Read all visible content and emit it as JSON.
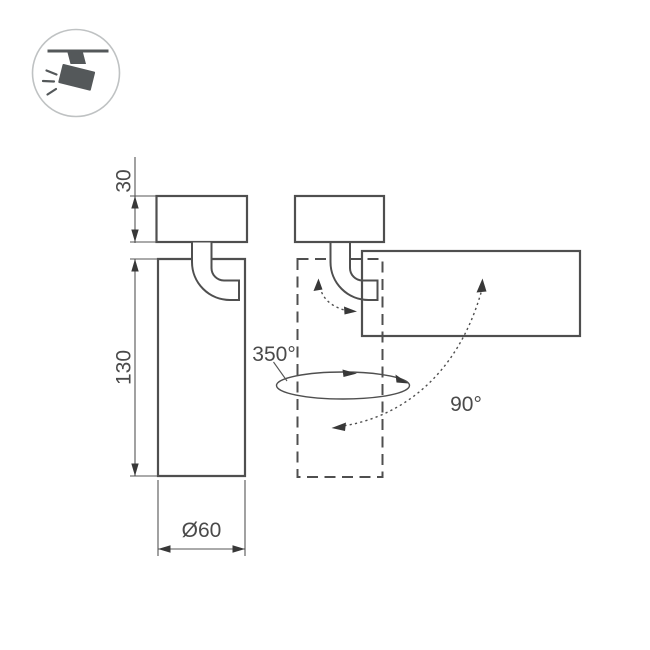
{
  "colors": {
    "background": "#ffffff",
    "outline": "#4f4f4f",
    "dimension_lines": "#555555",
    "text": "#4a4a4a",
    "icon": "#54585a",
    "icon_ring": "#bfc2c3"
  },
  "icon_badge": {
    "name": "ceiling-track-spotlight-icon"
  },
  "front_view": {
    "dimensions": {
      "base_height": "30",
      "body_height": "130",
      "diameter": "Ø60"
    }
  },
  "rotation_view": {
    "pan_angle": "350°",
    "tilt_angle": "90°"
  }
}
